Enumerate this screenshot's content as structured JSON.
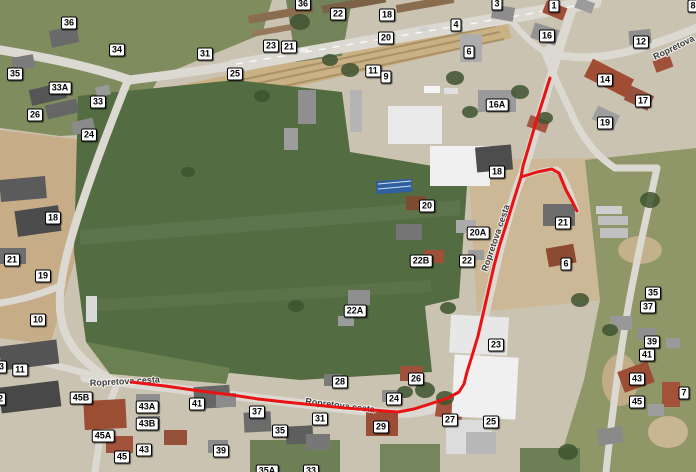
{
  "map": {
    "route": {
      "color": "#e81414",
      "width": 3,
      "main": [
        [
          550,
          78
        ],
        [
          543,
          100
        ],
        [
          536,
          122
        ],
        [
          529,
          146
        ],
        [
          523,
          166
        ],
        [
          521,
          177
        ],
        [
          515,
          196
        ],
        [
          507,
          222
        ],
        [
          500,
          244
        ],
        [
          494,
          266
        ],
        [
          489,
          288
        ],
        [
          484,
          310
        ],
        [
          478,
          336
        ],
        [
          472,
          356
        ],
        [
          467,
          372
        ],
        [
          464,
          384
        ],
        [
          459,
          392
        ],
        [
          448,
          398
        ],
        [
          433,
          403
        ],
        [
          414,
          409
        ],
        [
          398,
          412
        ],
        [
          372,
          410
        ],
        [
          345,
          408
        ],
        [
          315,
          405
        ],
        [
          285,
          402
        ],
        [
          258,
          399
        ],
        [
          232,
          395
        ],
        [
          200,
          391
        ],
        [
          165,
          386
        ],
        [
          131,
          382
        ]
      ],
      "branch": [
        [
          521,
          177
        ],
        [
          537,
          172
        ],
        [
          552,
          169
        ],
        [
          559,
          173
        ],
        [
          566,
          190
        ],
        [
          573,
          203
        ],
        [
          577,
          211
        ]
      ]
    },
    "street_labels": [
      {
        "text": "Ropretova cesta",
        "x": 90,
        "y": 386,
        "angle": -3
      },
      {
        "text": "Ropretova cesta",
        "x": 305,
        "y": 404,
        "angle": 7
      },
      {
        "text": "Ropretova cesta",
        "x": 487,
        "y": 272,
        "angle": -71
      },
      {
        "text": "Ropretova",
        "x": 655,
        "y": 60,
        "angle": -26
      }
    ],
    "badges": [
      {
        "label": "36",
        "x": 69,
        "y": 23
      },
      {
        "label": "34",
        "x": 117,
        "y": 50
      },
      {
        "label": "31",
        "x": 205,
        "y": 54
      },
      {
        "label": "35",
        "x": 15,
        "y": 74
      },
      {
        "label": "33A",
        "x": 60,
        "y": 88
      },
      {
        "label": "33",
        "x": 98,
        "y": 102
      },
      {
        "label": "26",
        "x": 35,
        "y": 115
      },
      {
        "label": "24",
        "x": 89,
        "y": 135
      },
      {
        "label": "36",
        "x": 303,
        "y": 4
      },
      {
        "label": "22",
        "x": 338,
        "y": 14
      },
      {
        "label": "18",
        "x": 387,
        "y": 15
      },
      {
        "label": "4",
        "x": 456,
        "y": 25
      },
      {
        "label": "20",
        "x": 386,
        "y": 38
      },
      {
        "label": "23",
        "x": 271,
        "y": 46
      },
      {
        "label": "21",
        "x": 289,
        "y": 47
      },
      {
        "label": "25",
        "x": 235,
        "y": 74
      },
      {
        "label": "11",
        "x": 373,
        "y": 71
      },
      {
        "label": "9",
        "x": 386,
        "y": 77
      },
      {
        "label": "3",
        "x": 497,
        "y": 4
      },
      {
        "label": "1",
        "x": 554,
        "y": 6
      },
      {
        "label": "16",
        "x": 547,
        "y": 36
      },
      {
        "label": "12",
        "x": 641,
        "y": 42
      },
      {
        "label": "6",
        "x": 469,
        "y": 52
      },
      {
        "label": "8",
        "x": 693,
        "y": 6
      },
      {
        "label": "14",
        "x": 605,
        "y": 80
      },
      {
        "label": "17",
        "x": 643,
        "y": 101
      },
      {
        "label": "16A",
        "x": 497,
        "y": 105
      },
      {
        "label": "19",
        "x": 605,
        "y": 123
      },
      {
        "label": "18",
        "x": 53,
        "y": 218
      },
      {
        "label": "21",
        "x": 12,
        "y": 260
      },
      {
        "label": "19",
        "x": 43,
        "y": 276
      },
      {
        "label": "10",
        "x": 38,
        "y": 320
      },
      {
        "label": "20",
        "x": 427,
        "y": 206
      },
      {
        "label": "22B",
        "x": 421,
        "y": 261
      },
      {
        "label": "22A",
        "x": 355,
        "y": 311
      },
      {
        "label": "18",
        "x": 497,
        "y": 172
      },
      {
        "label": "21",
        "x": 563,
        "y": 223
      },
      {
        "label": "20A",
        "x": 478,
        "y": 233
      },
      {
        "label": "22",
        "x": 467,
        "y": 261
      },
      {
        "label": "6",
        "x": 566,
        "y": 264
      },
      {
        "label": "35",
        "x": 653,
        "y": 293
      },
      {
        "label": "37",
        "x": 648,
        "y": 307
      },
      {
        "label": "13",
        "x": -1,
        "y": 367
      },
      {
        "label": "11",
        "x": 20,
        "y": 370
      },
      {
        "label": "12",
        "x": -2,
        "y": 399
      },
      {
        "label": "45B",
        "x": 81,
        "y": 398
      },
      {
        "label": "41",
        "x": 197,
        "y": 404
      },
      {
        "label": "43A",
        "x": 147,
        "y": 407
      },
      {
        "label": "43B",
        "x": 147,
        "y": 424
      },
      {
        "label": "45A",
        "x": 103,
        "y": 436
      },
      {
        "label": "43",
        "x": 144,
        "y": 450
      },
      {
        "label": "45",
        "x": 122,
        "y": 457
      },
      {
        "label": "39",
        "x": 221,
        "y": 451
      },
      {
        "label": "37",
        "x": 257,
        "y": 412
      },
      {
        "label": "28",
        "x": 340,
        "y": 382
      },
      {
        "label": "31",
        "x": 320,
        "y": 419
      },
      {
        "label": "26",
        "x": 416,
        "y": 379
      },
      {
        "label": "24",
        "x": 394,
        "y": 399
      },
      {
        "label": "29",
        "x": 381,
        "y": 427
      },
      {
        "label": "27",
        "x": 450,
        "y": 420
      },
      {
        "label": "35",
        "x": 280,
        "y": 431
      },
      {
        "label": "35A",
        "x": 267,
        "y": 471
      },
      {
        "label": "33",
        "x": 311,
        "y": 471
      },
      {
        "label": "23",
        "x": 496,
        "y": 345
      },
      {
        "label": "25",
        "x": 491,
        "y": 422
      },
      {
        "label": "39",
        "x": 652,
        "y": 342
      },
      {
        "label": "41",
        "x": 647,
        "y": 355
      },
      {
        "label": "43",
        "x": 637,
        "y": 379
      },
      {
        "label": "45",
        "x": 637,
        "y": 402
      },
      {
        "label": "7",
        "x": 684,
        "y": 393
      }
    ]
  }
}
